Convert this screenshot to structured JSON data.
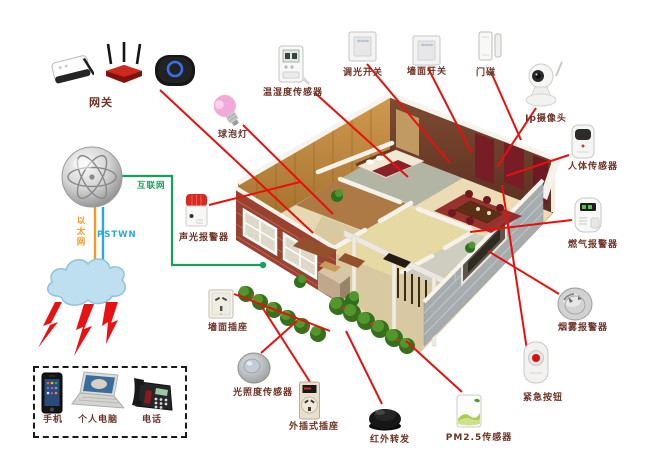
{
  "colors": {
    "line_red": "#e8100c",
    "net_green": "#18a05a",
    "ethernet_orange": "#f59a23",
    "pstn_blue": "#2aa8e0",
    "label_text": "#6e3226"
  },
  "gateway": {
    "label": "网关",
    "label_pos": [
      101,
      94
    ],
    "icons": {
      "ap": [
        48,
        50,
        46,
        38
      ],
      "router": [
        103,
        42,
        42,
        44
      ],
      "hub": [
        152,
        53,
        46,
        35
      ]
    },
    "line": [
      160,
      90,
      313,
      233
    ]
  },
  "network": {
    "internet": "互联网",
    "ethernet": "以太网",
    "pstn": "PSTWN",
    "internet_pos": [
      137,
      179
    ],
    "ethernet_pos": [
      74,
      216
    ],
    "pstn_pos": [
      97,
      230
    ],
    "green_path": "120,176 172,176 172,265 263,265",
    "green_dot": [
      263,
      265
    ],
    "ethernet_line": [
      95,
      206,
      95,
      263
    ],
    "pstn_line": [
      103,
      207,
      103,
      264
    ]
  },
  "devices": [
    {
      "id": "bulb",
      "label": "球泡灯",
      "icon": [
        211,
        92,
        34,
        38
      ],
      "label_pos": [
        233,
        127
      ],
      "line": [
        243,
        125,
        333,
        214
      ]
    },
    {
      "id": "temp_humidity",
      "label": "温湿度传感器",
      "icon": [
        273,
        42,
        38,
        46
      ],
      "label_pos": [
        293,
        85
      ],
      "line": [
        315,
        93,
        408,
        177
      ]
    },
    {
      "id": "dimmer",
      "label": "调光开关",
      "icon": [
        347,
        30,
        31,
        33
      ],
      "label_pos": [
        363,
        65
      ],
      "line": [
        367,
        64,
        450,
        163
      ]
    },
    {
      "id": "wall_switch",
      "label": "墙面开关",
      "icon": [
        411,
        34,
        31,
        33
      ],
      "label_pos": [
        427,
        64
      ],
      "line": [
        428,
        68,
        471,
        152
      ]
    },
    {
      "id": "door_magnet",
      "label": "门磁",
      "icon": [
        476,
        28,
        28,
        36
      ],
      "label_pos": [
        486,
        65
      ],
      "line": [
        491,
        72,
        521,
        140
      ]
    },
    {
      "id": "ip_camera",
      "label": "Ip摄像头",
      "icon": [
        521,
        60,
        44,
        48
      ],
      "label_pos": [
        546,
        111
      ],
      "line": [
        536,
        108,
        497,
        167
      ]
    },
    {
      "id": "body_sensor",
      "label": "人体传感器",
      "icon": [
        567,
        122,
        32,
        40
      ],
      "label_pos": [
        593,
        159
      ],
      "line": [
        569,
        155,
        506,
        176
      ]
    },
    {
      "id": "gas_alarm",
      "label": "燃气报警器",
      "icon": [
        569,
        194,
        38,
        42
      ],
      "label_pos": [
        593,
        237
      ],
      "line": [
        572,
        220,
        470,
        232
      ]
    },
    {
      "id": "smoke_alarm",
      "label": "烟雾报警器",
      "icon": [
        556,
        286,
        38,
        36
      ],
      "label_pos": [
        583,
        320
      ],
      "line": [
        559,
        294,
        488,
        251
      ]
    },
    {
      "id": "emergency",
      "label": "紧急按钮",
      "icon": [
        520,
        340,
        32,
        46
      ],
      "label_pos": [
        543,
        390
      ],
      "line": [
        527,
        350,
        502,
        185
      ]
    },
    {
      "id": "pm25",
      "label": "PM2.5传感器",
      "icon": [
        454,
        392,
        30,
        38
      ],
      "label_pos": [
        479,
        430
      ],
      "line": [
        462,
        392,
        406,
        341
      ]
    },
    {
      "id": "ir_repeater",
      "label": "红外转发",
      "icon": [
        366,
        404,
        38,
        28
      ],
      "label_pos": [
        390,
        432
      ],
      "line": [
        382,
        404,
        346,
        331
      ]
    },
    {
      "id": "plug_socket",
      "label": "外插式插座",
      "icon": [
        298,
        380,
        23,
        41
      ],
      "label_pos": [
        314,
        419
      ],
      "line": [
        310,
        382,
        262,
        307
      ]
    },
    {
      "id": "light_sensor",
      "label": "光照度传感器",
      "icon": [
        237,
        352,
        34,
        33
      ],
      "label_pos": [
        263,
        385
      ],
      "line": [
        261,
        353,
        297,
        321
      ]
    },
    {
      "id": "wall_socket",
      "label": "墙面插座",
      "icon": [
        207,
        288,
        28,
        32
      ],
      "label_pos": [
        228,
        320
      ],
      "line": [
        234,
        294,
        330,
        331
      ]
    },
    {
      "id": "sound_light",
      "label": "声光报警器",
      "icon": [
        182,
        192,
        29,
        37
      ],
      "label_pos": [
        204,
        230
      ],
      "line": [
        209,
        205,
        300,
        182
      ]
    }
  ],
  "clients": {
    "box": [
      33,
      366,
      150,
      68
    ],
    "items": [
      {
        "id": "phone",
        "label": "手机",
        "icon": [
          40,
          372,
          24,
          42
        ],
        "label_pos": [
          53,
          412
        ]
      },
      {
        "id": "laptop",
        "label": "个人电脑",
        "icon": [
          70,
          370,
          54,
          44
        ],
        "label_pos": [
          98,
          412
        ]
      },
      {
        "id": "deskphone",
        "label": "电话",
        "icon": [
          130,
          374,
          46,
          40
        ],
        "label_pos": [
          152,
          412
        ]
      }
    ]
  }
}
